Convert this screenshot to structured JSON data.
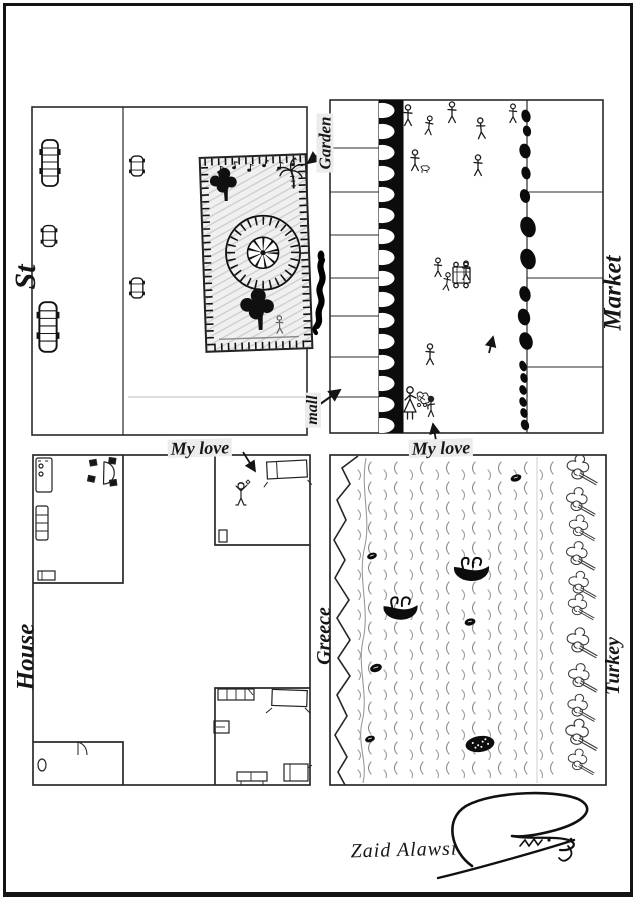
{
  "colors": {
    "paper": "#ffffff",
    "ink": "#161616",
    "pencil_gray": "#9a9a9a",
    "shading_gray": "#d2d2d2"
  },
  "labels": {
    "street": "St",
    "garden": "Garden",
    "mall": "mall",
    "market": "Market",
    "house": "House",
    "greece": "Greece",
    "turkey": "Turkey",
    "my_love_house": "My love",
    "my_love_market": "My love"
  },
  "signature": {
    "artist_name": "Zaid Alawsi"
  },
  "icons": {
    "street": [
      "bus-icon",
      "car-icon"
    ],
    "garden": [
      "ferris-wheel-icon",
      "tree-icon",
      "palm-tree-icon",
      "music-note-icon",
      "fence-border"
    ],
    "market": [
      "pine-tree-row",
      "bush-row",
      "pedestrian-icon",
      "vendor-cart-icon",
      "mother-icon",
      "child-icon",
      "direction-arrow"
    ],
    "house": [
      "bed-icon",
      "table-and-chairs-icon",
      "cabinet-icon",
      "wardrobe-icon",
      "door-icon",
      "beloved-person-icon"
    ],
    "sea": [
      "boat-icon",
      "raft-icon",
      "wave-texture",
      "coastline",
      "shore-tree-icon"
    ]
  }
}
